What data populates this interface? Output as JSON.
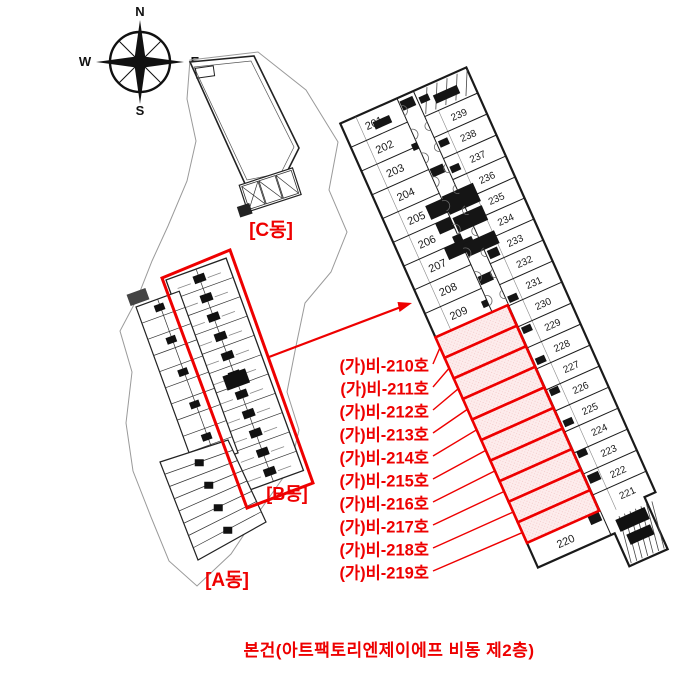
{
  "compass": {
    "north": "N",
    "south": "S",
    "west": "W",
    "east": "E"
  },
  "site_plan": {
    "building_labels": [
      {
        "id": "c",
        "label": "[C동]"
      },
      {
        "id": "b",
        "label": "[B동]"
      },
      {
        "id": "a",
        "label": "[A동]"
      }
    ]
  },
  "detail_plan": {
    "left_units": [
      "201",
      "202",
      "203",
      "204",
      "205",
      "206",
      "207",
      "208",
      "209"
    ],
    "bottom_unit": "220",
    "right_units": [
      "239",
      "238",
      "237",
      "236",
      "235",
      "234",
      "233",
      "232",
      "231",
      "230",
      "229",
      "228",
      "227",
      "226",
      "225",
      "224",
      "223",
      "222",
      "221"
    ],
    "highlighted_callouts": [
      "(가)비-210호",
      "(가)비-211호",
      "(가)비-212호",
      "(가)비-213호",
      "(가)비-214호",
      "(가)비-215호",
      "(가)비-216호",
      "(가)비-217호",
      "(가)비-218호",
      "(가)비-219호"
    ]
  },
  "caption": "본건(아트팩토리엔제이에프 비동 제2층)",
  "colors": {
    "red": "#ee0000",
    "highlight_fill": "#fdecec",
    "highlight_dot": "#f2c2c2",
    "line": "#1a1a1a",
    "soft_line": "#555555",
    "parcel": "#9a9a9a"
  }
}
